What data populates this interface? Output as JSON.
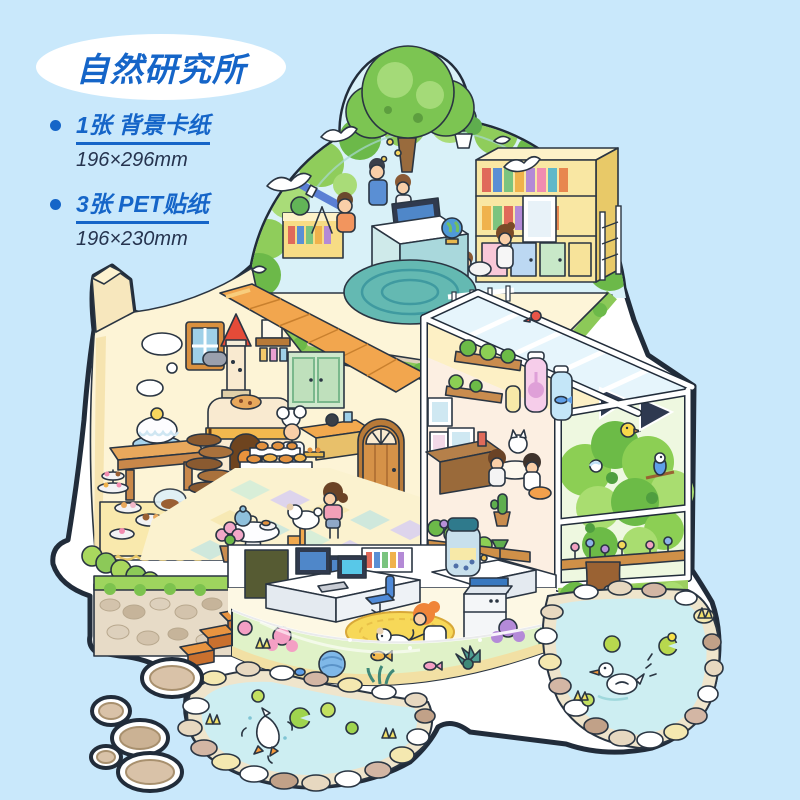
{
  "badge": {
    "title": "自然研究所",
    "title_color": "#1565c8",
    "bg": "#ffffff"
  },
  "specs": [
    {
      "label": "1张 背景卡纸",
      "size": "196×296mm"
    },
    {
      "label": "3张 PET贴纸",
      "size": "196×230mm"
    }
  ],
  "background_color": "#c9e8fb",
  "text_colors": {
    "label": "#1565c8",
    "size": "#26344f"
  },
  "illustration": {
    "alt": "isometric nature research institute playhouse sticker scene",
    "outline_color": "#212c3a",
    "sticker_border": "#ffffff",
    "elements": [
      "glass-dome-study",
      "big-tree",
      "white-doves",
      "telescope",
      "bookshelf",
      "wall-plant",
      "computer-desk",
      "globe",
      "round-rug",
      "bakery-kitchen",
      "plank-roof",
      "oven-tower",
      "chef-kid",
      "green-cupboard",
      "arched-door",
      "window",
      "clouds",
      "cake-table",
      "dessert-table",
      "spiral-staircase",
      "checkered-floor",
      "tea-table",
      "girl-with-poodle",
      "greenhouse",
      "roof-glass",
      "specimen-jars",
      "plant-shelves",
      "study-nook-kids",
      "cactus",
      "flower-bed",
      "aviary-bushes",
      "parakeet",
      "chicks",
      "tree-trunk",
      "basement-lab",
      "lab-desk",
      "lab-monitors",
      "copier",
      "specimen-jar",
      "lab-chair",
      "yellow-rug",
      "scientist-girl",
      "lab-dog",
      "aquarium-band",
      "corals",
      "fish",
      "stone-wall",
      "wooden-stairs",
      "left-pond",
      "diving-duck",
      "lily-pads",
      "right-pond",
      "swimming-duck",
      "stepping-stones"
    ],
    "palette": {
      "sky": "#d9f1f8",
      "bush": "#8fcd5b",
      "bush_dark": "#6cb949",
      "tree": "#7cc552",
      "cream_wall": "#fdf4d6",
      "roof": "#f2a64e",
      "roof_light": "#f8cd7d",
      "red_cone": "#e54b38",
      "mint_cupboard": "#cfe8cc",
      "wood": "#d59248",
      "shelf_yellow": "#f9e7a3",
      "rug_teal": "#64b9b2",
      "water": "#cdeef2",
      "aquarium_water": "#e0f2c8",
      "stone": "#d9c2a8",
      "coral_pink": "#f49fc4",
      "coral_blue": "#7fb8e8",
      "coral_purple": "#b48ad8",
      "duck_orange": "#f4983b",
      "lab_rug": "#f7d858",
      "frame_white": "#ffffff",
      "glass_pane_dark": "#2e3950"
    }
  }
}
